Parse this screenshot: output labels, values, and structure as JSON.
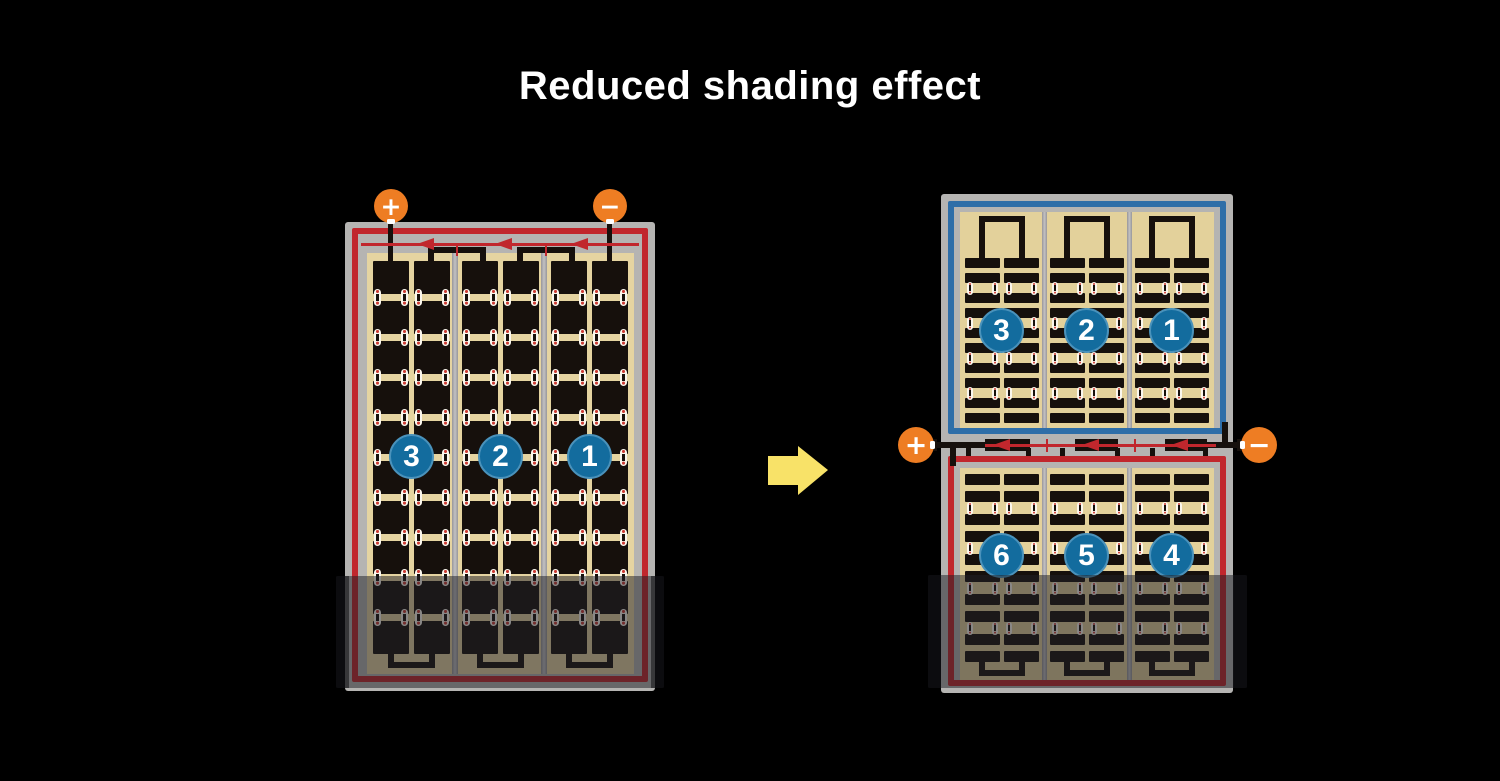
{
  "title": "Reduced shading effect",
  "colors": {
    "background": "#000000",
    "panel_frame_gray": "#b5b4b2",
    "cell_field_tan": "#e5d4a1",
    "cell_dark": "#271d14",
    "circuit_red": "#c1272d",
    "module_blue": "#2e6ea8",
    "badge_blue": "#136c9e",
    "terminal_orange": "#ee7d23",
    "arrow_yellow": "#f8e268"
  },
  "left_module": {
    "rows": 10,
    "columns": 6,
    "strings": [
      {
        "label": "3"
      },
      {
        "label": "2"
      },
      {
        "label": "1"
      }
    ],
    "terminals": [
      {
        "symbol": "+"
      },
      {
        "symbol": "−"
      }
    ],
    "bypass_diodes": 3,
    "shaded_bottom": true
  },
  "right_module": {
    "top_half": {
      "rows": 10,
      "columns": 6,
      "strings": [
        {
          "label": "3"
        },
        {
          "label": "2"
        },
        {
          "label": "1"
        }
      ]
    },
    "bottom_half": {
      "rows": 10,
      "columns": 6,
      "strings": [
        {
          "label": "6"
        },
        {
          "label": "5"
        },
        {
          "label": "4"
        }
      ]
    },
    "terminals": [
      {
        "symbol": "+"
      },
      {
        "symbol": "−"
      }
    ],
    "bypass_diodes": 3,
    "shaded_bottom": true
  },
  "arrow": {
    "direction": "right"
  }
}
